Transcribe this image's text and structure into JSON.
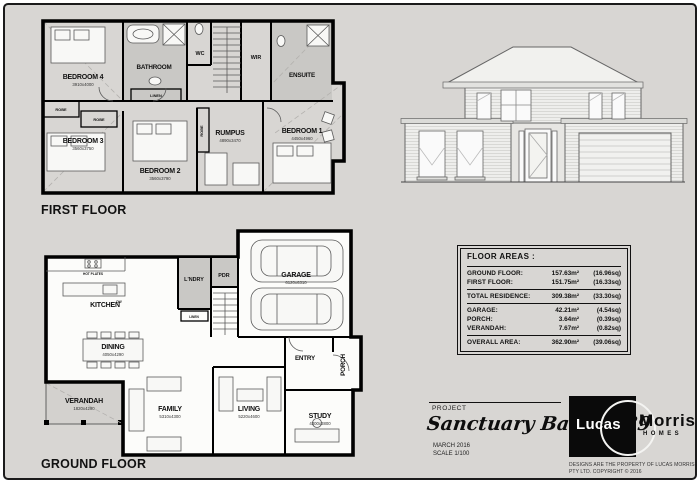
{
  "page": {
    "first_floor_label": "FIRST FLOOR",
    "ground_floor_label": "GROUND FLOOR",
    "colors": {
      "sheet_bg": "#d8d6d3",
      "wall": "#000000",
      "room_shade": "#c9c8c5",
      "logo_bg": "#0a0a0a"
    }
  },
  "first_floor": {
    "rooms": {
      "bedroom4": {
        "name": "BEDROOM 4",
        "dims": "3910x4000"
      },
      "bathroom": {
        "name": "BATHROOM"
      },
      "wc": {
        "name": "WC"
      },
      "wir": {
        "name": "WIR"
      },
      "ensuite": {
        "name": "ENSUITE"
      },
      "linen": {
        "name": "LINEN"
      },
      "robe1": {
        "name": "ROBE"
      },
      "robe2": {
        "name": "ROBE"
      },
      "robe3": {
        "name": "ROBE"
      },
      "bedroom3": {
        "name": "BEDROOM 3",
        "dims": "3560x3750"
      },
      "bedroom2": {
        "name": "BEDROOM 2",
        "dims": "3560x3790"
      },
      "rumpus": {
        "name": "RUMPUS",
        "dims": "4890x3470"
      },
      "bedroom1": {
        "name": "BEDROOM 1",
        "dims": "4450x4960"
      }
    }
  },
  "ground_floor": {
    "rooms": {
      "kitchen": {
        "name": "KITCHEN"
      },
      "hot_plates": {
        "name": "HOT PLATES"
      },
      "dw": {
        "name": "DW"
      },
      "laundry": {
        "name": "L'NDRY"
      },
      "linen": {
        "name": "LINEN"
      },
      "pdr": {
        "name": "PDR"
      },
      "garage": {
        "name": "GARAGE",
        "dims": "6120x6310"
      },
      "dining": {
        "name": "DINING",
        "dims": "4050x4290"
      },
      "entry": {
        "name": "ENTRY"
      },
      "porch": {
        "name": "PORCH"
      },
      "verandah": {
        "name": "VERANDAH",
        "dims": "1820x4290"
      },
      "family": {
        "name": "FAMILY",
        "dims": "5310x4300"
      },
      "living": {
        "name": "LIVING",
        "dims": "5220x4600"
      },
      "study": {
        "name": "STUDY",
        "dims": "4300x3800"
      }
    }
  },
  "floor_areas": {
    "title": "FLOOR AREAS :",
    "rows": [
      {
        "label": "GROUND FLOOR:",
        "m2": "157.63m²",
        "sq": "(16.96sq)"
      },
      {
        "label": "FIRST FLOOR:",
        "m2": "151.75m²",
        "sq": "(16.33sq)"
      },
      {
        "label": "TOTAL RESIDENCE:",
        "m2": "309.38m²",
        "sq": "(33.30sq)"
      },
      {
        "label": "GARAGE:",
        "m2": "42.21m²",
        "sq": "(4.54sq)"
      },
      {
        "label": "PORCH:",
        "m2": "3.64m²",
        "sq": "(0.39sq)"
      },
      {
        "label": "VERANDAH:",
        "m2": "7.67m²",
        "sq": "(0.82sq)"
      },
      {
        "label": "OVERALL AREA:",
        "m2": "362.90m²",
        "sq": "(39.06sq)"
      }
    ]
  },
  "project": {
    "label": "PROJECT",
    "name": "Sanctuary Balwyn 39",
    "date": "MARCH 2016",
    "scale": "SCALE 1/100",
    "logo": {
      "word1": "Lucas",
      "word2": "Morris",
      "sub": "HOMES"
    },
    "disclaimer": "DESIGNS ARE THE PROPERTY OF LUCAS MORRIS PTY LTD. COPYRIGHT © 2016"
  }
}
